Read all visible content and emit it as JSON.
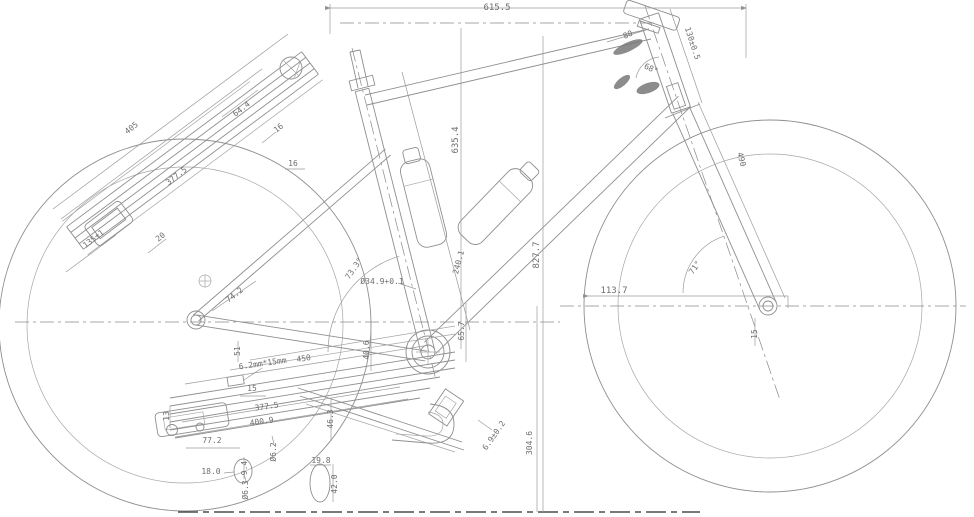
{
  "meta": {
    "type": "cad-engineering-drawing",
    "subject": "bicycle frame geometry drawing with dimension annotations",
    "background": "#ffffff",
    "line_color": "#8f8f8f",
    "text_color": "#6e6e6e"
  },
  "chart_data": {
    "type": "table",
    "title": "Bicycle frame dimension callouts (mm / degrees)",
    "values": [
      "615.5",
      "130±0.5",
      "80",
      "68°",
      "635.4",
      "827.7",
      "490",
      "71°",
      "113.7",
      "405",
      "64.4",
      "16",
      "16",
      "377.5",
      "135±1",
      "20",
      "74.2",
      "73.3°",
      "Ø34.9+0.1",
      "240.1",
      "65.7",
      "40.6",
      "51",
      "6.2mm*15mm",
      "450",
      "15",
      "377.5",
      "400.9",
      "13",
      "77.2",
      "18.0",
      "9.4",
      "Ø6.3",
      "Ø6.2",
      "46.3",
      "19.8",
      "42.0",
      "6.9±0.2",
      "304.6",
      "15"
    ]
  },
  "dimensions": [
    {
      "t": "615.5",
      "x": 497,
      "y": 10,
      "r": 0,
      "big": true
    },
    {
      "t": "130±0.5",
      "x": 690,
      "y": 44,
      "r": 72
    },
    {
      "t": "80",
      "x": 629,
      "y": 37,
      "r": -25
    },
    {
      "t": "68°",
      "x": 650,
      "y": 71,
      "r": 25
    },
    {
      "t": "635.4",
      "x": 458,
      "y": 140,
      "r": -90,
      "big": true
    },
    {
      "t": "827.7",
      "x": 539,
      "y": 255,
      "r": -90,
      "big": true
    },
    {
      "t": "490",
      "x": 739,
      "y": 160,
      "r": 75
    },
    {
      "t": "71°",
      "x": 697,
      "y": 269,
      "r": -55
    },
    {
      "t": "113.7",
      "x": 614,
      "y": 293,
      "r": 0,
      "big": true
    },
    {
      "t": "405",
      "x": 133,
      "y": 130,
      "r": -38
    },
    {
      "t": "64.4",
      "x": 243,
      "y": 111,
      "r": -38
    },
    {
      "t": "16",
      "x": 280,
      "y": 130,
      "r": -38
    },
    {
      "t": "16",
      "x": 293,
      "y": 166,
      "r": 0
    },
    {
      "t": "377.5",
      "x": 178,
      "y": 178,
      "r": -38
    },
    {
      "t": "135±1",
      "x": 95,
      "y": 241,
      "r": -38
    },
    {
      "t": "20",
      "x": 162,
      "y": 239,
      "r": -38
    },
    {
      "t": "74.2",
      "x": 236,
      "y": 297,
      "r": -38
    },
    {
      "t": "73.3°",
      "x": 356,
      "y": 270,
      "r": -55
    },
    {
      "t": "Ø34.9+0.1",
      "x": 382,
      "y": 284,
      "r": 0
    },
    {
      "t": "240.1",
      "x": 461,
      "y": 263,
      "r": -75
    },
    {
      "t": "65.7",
      "x": 464,
      "y": 331,
      "r": -90
    },
    {
      "t": "40.6",
      "x": 369,
      "y": 350,
      "r": -90
    },
    {
      "t": "51",
      "x": 240,
      "y": 351,
      "r": -90
    },
    {
      "t": "6.2mm*15mm",
      "x": 263,
      "y": 366,
      "r": -8
    },
    {
      "t": "450",
      "x": 304,
      "y": 361,
      "r": -8
    },
    {
      "t": "15",
      "x": 252,
      "y": 391,
      "r": 0
    },
    {
      "t": "377.5",
      "x": 267,
      "y": 409,
      "r": -8
    },
    {
      "t": "400.9",
      "x": 262,
      "y": 424,
      "r": -8
    },
    {
      "t": "13",
      "x": 169,
      "y": 416,
      "r": -90
    },
    {
      "t": "77.2",
      "x": 212,
      "y": 443,
      "r": 0
    },
    {
      "t": "18.0",
      "x": 211,
      "y": 474,
      "r": 0
    },
    {
      "t": "9.4",
      "x": 247,
      "y": 468,
      "r": -90
    },
    {
      "t": "Ø6.3",
      "x": 248,
      "y": 490,
      "r": -90
    },
    {
      "t": "Ø6.2",
      "x": 276,
      "y": 452,
      "r": -90
    },
    {
      "t": "46.3",
      "x": 333,
      "y": 419,
      "r": -90
    },
    {
      "t": "19.8",
      "x": 321,
      "y": 463,
      "r": 0
    },
    {
      "t": "42.0",
      "x": 337,
      "y": 484,
      "r": -90
    },
    {
      "t": "6.9±0.2",
      "x": 496,
      "y": 437,
      "r": -55
    },
    {
      "t": "304.6",
      "x": 532,
      "y": 443,
      "r": -90
    },
    {
      "t": "15",
      "x": 757,
      "y": 334,
      "r": -90
    }
  ]
}
